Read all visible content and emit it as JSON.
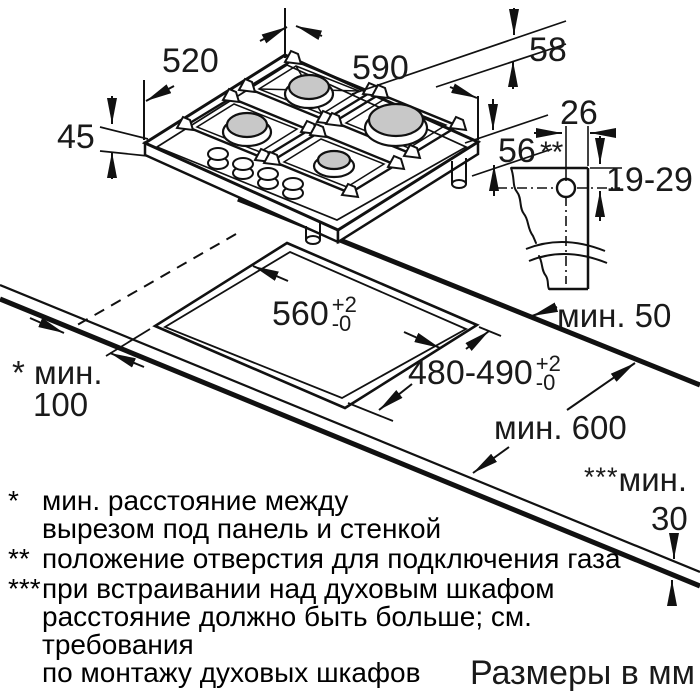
{
  "diagram": {
    "title_units": "Размеры в мм",
    "hob": {
      "width_label": "590",
      "depth_label": "520",
      "height_label": "45",
      "edge_height_label": "58",
      "below_height_label": "56"
    },
    "gas_connection": {
      "offset_label": "26",
      "hole_marker": "**",
      "range_label": "19-29"
    },
    "cutout": {
      "width_base": "560",
      "width_tol_plus": "+2",
      "width_tol_minus": "-0",
      "depth_base": "480-490",
      "depth_tol_plus": "+2",
      "depth_tol_minus": "-0"
    },
    "clearances": {
      "rear_label": "мин. 50",
      "side_star": "*",
      "side_label": "мин.",
      "side_value": "100",
      "worktop_depth_label": "мин. 600",
      "front_stars": "***",
      "front_label": "мин.",
      "front_value": "30"
    }
  },
  "footnotes": [
    {
      "marker": "*",
      "lines": [
        "мин. расстояние между",
        "вырезом под панель и стенкой"
      ]
    },
    {
      "marker": "**",
      "lines": [
        "положение отверстия для подключения газа"
      ]
    },
    {
      "marker": "***",
      "lines": [
        "при встраивании над духовым шкафом",
        "расстояние должно быть больше; см. требования",
        "по монтажу духовых шкафов"
      ]
    }
  ]
}
